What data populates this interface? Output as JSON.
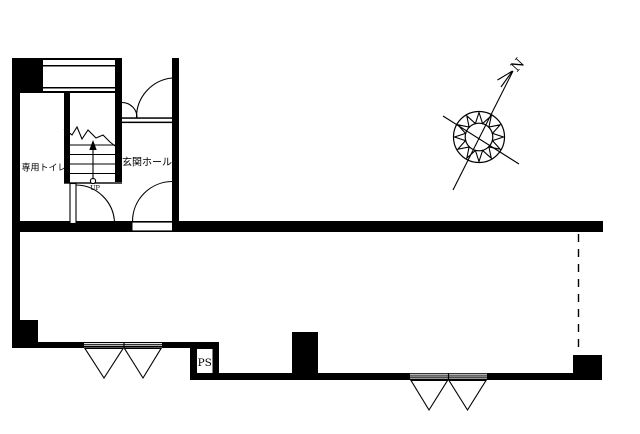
{
  "colors": {
    "ink": "#000000",
    "paper": "#ffffff"
  },
  "labels": {
    "toilet": "専用トイレ",
    "entrance_hall": "玄関ホール",
    "stairs_up": "UP",
    "pipe_space": "PS",
    "north": "N"
  }
}
